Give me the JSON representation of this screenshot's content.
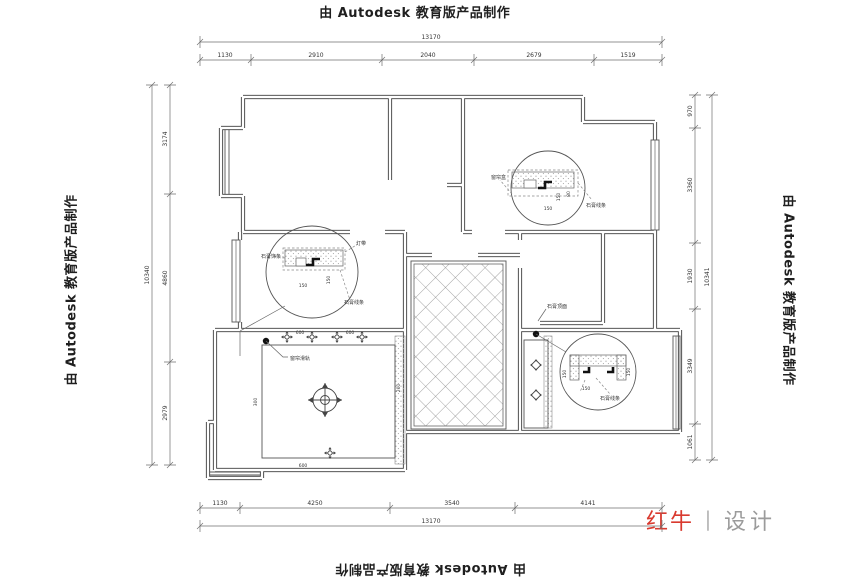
{
  "watermark": {
    "text": "由 Autodesk 教育版产品制作"
  },
  "logo": {
    "brand": "红牛",
    "divider": "丨",
    "suffix": "设计"
  },
  "dims": {
    "top": {
      "total": "13170",
      "segments": [
        "1130",
        "2910",
        "2040",
        "2679",
        "1519"
      ]
    },
    "bottom": {
      "total": "13170",
      "segments": [
        "1130",
        "4250",
        "3540",
        "4141"
      ]
    },
    "left": {
      "total": "10340",
      "segments": [
        "3174",
        "4860",
        "2979"
      ]
    },
    "right": {
      "total": "10341",
      "segments": [
        "970",
        "3360",
        "1930",
        "3349",
        "1061"
      ]
    }
  },
  "labels": {
    "curtain_track": "窗帘滑轨",
    "ceiling_surface": "石膏顶面",
    "detail_top_right": {
      "left": "窗帘盒",
      "right": "石膏线条",
      "dim1": "150",
      "dim2": "80"
    },
    "detail_mid_left": {
      "left": "石膏饰条",
      "lamp": "灯带",
      "bottom": "石膏线条",
      "dim": "150"
    },
    "detail_bottom_right": {
      "dim": "150",
      "label": "石膏线条"
    },
    "living_room": {
      "left_offset": "300",
      "right_offset": "200",
      "bottom_offset": "600",
      "gap1": "600",
      "gap2": "600"
    }
  },
  "colors": {
    "line": "#3c3c3c",
    "dim": "#707070",
    "logo_red": "#d93a2f",
    "logo_gray": "#9b9b9b"
  }
}
